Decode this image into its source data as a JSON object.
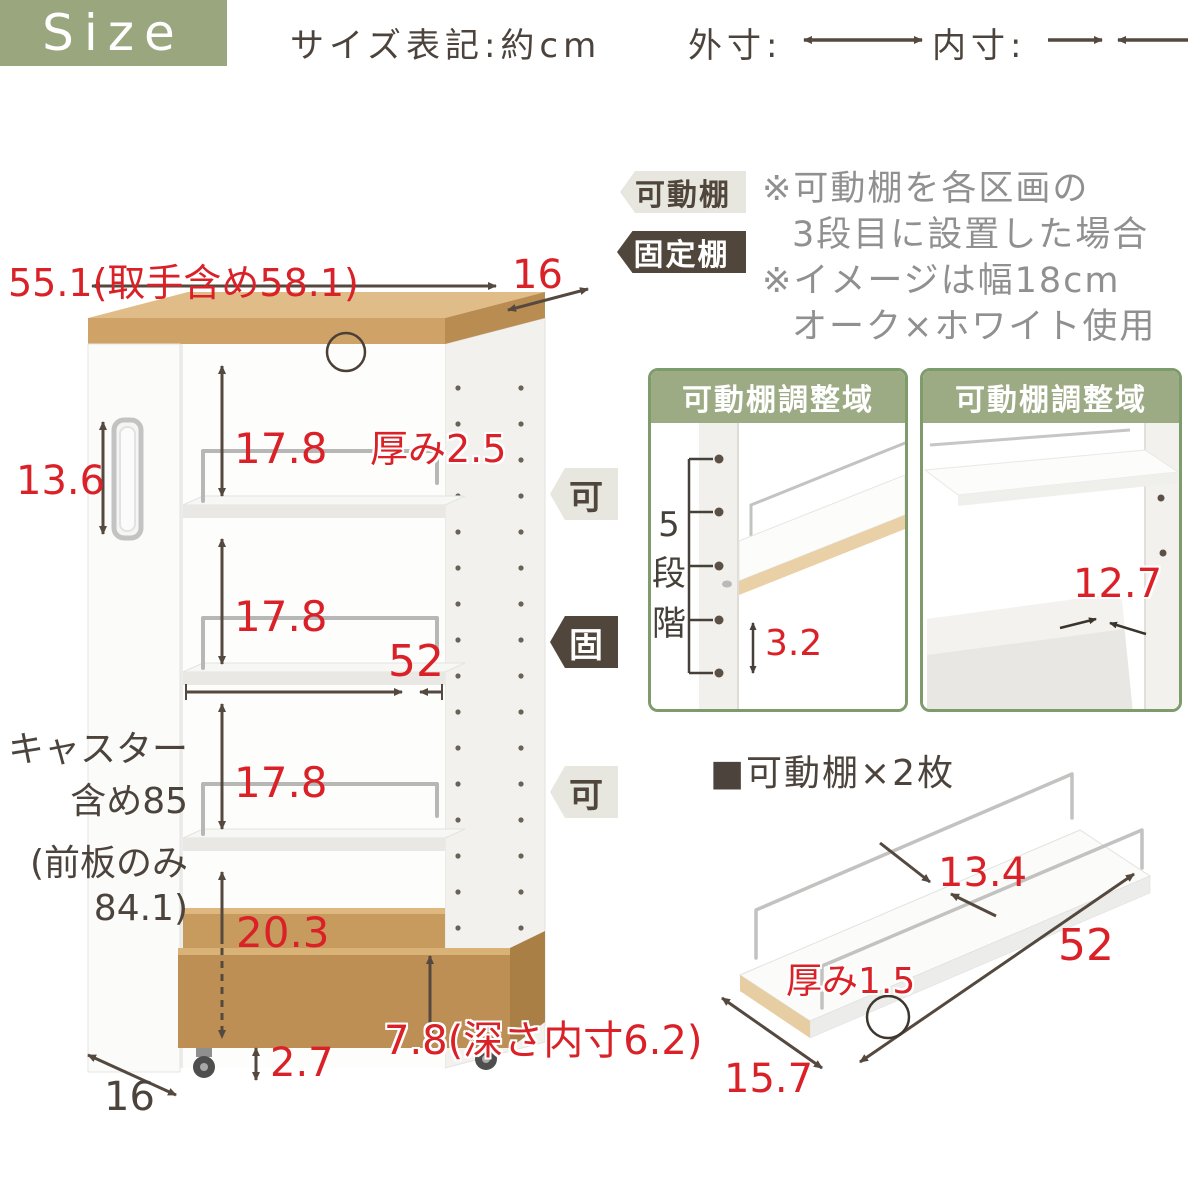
{
  "colors": {
    "accent_green": "#99a67e",
    "inset_border_green": "#7e9b6c",
    "accent_red": "#d92127",
    "arrow_brown": "#55493f",
    "note_gray": "#909090",
    "badge_light_bg": "#e7e6df",
    "badge_dark_bg": "#50463c",
    "wood_top": "#e0bd88",
    "wood_front": "#cfa368"
  },
  "header": {
    "size_label": "Size",
    "subtitle": "サイズ表記:約cm",
    "outer_label": "外寸:",
    "inner_label": "内寸:"
  },
  "legend": {
    "movable_tag": "可動棚",
    "fixed_tag": "固定棚",
    "note1": "※可動棚を各区画の",
    "note2": "3段目に設置した場合",
    "note3": "※イメージは幅18cm",
    "note4": "オーク×ホワイト使用"
  },
  "cart": {
    "width": "55.1(取手含め58.1)",
    "top_depth": "16",
    "handle_height": "13.6",
    "board_thickness": "厚み2.5",
    "shelf_gap_1": "17.8",
    "shelf_gap_2": "17.8",
    "shelf_gap_3": "17.8",
    "inner_width": "52",
    "bottom_gap": "20.3",
    "caster_height": "2.7",
    "box_height": "7.8(深さ内寸6.2)",
    "bottom_depth": "16",
    "height_line1": "キャスター",
    "height_line2": "含め85",
    "height_line3": "(前板のみ",
    "height_line4": "84.1)",
    "badge_movable": "可",
    "badge_fixed": "固"
  },
  "insets": {
    "left": {
      "title": "可動棚調整域",
      "steps": "5段階",
      "hole_pitch": "3.2"
    },
    "right": {
      "title": "可動棚調整域",
      "inner_depth": "12.7"
    }
  },
  "shelf_detail": {
    "heading": "■可動棚×2枚",
    "inner_depth": "13.4",
    "length": "52",
    "thickness": "厚み1.5",
    "depth": "15.7"
  }
}
